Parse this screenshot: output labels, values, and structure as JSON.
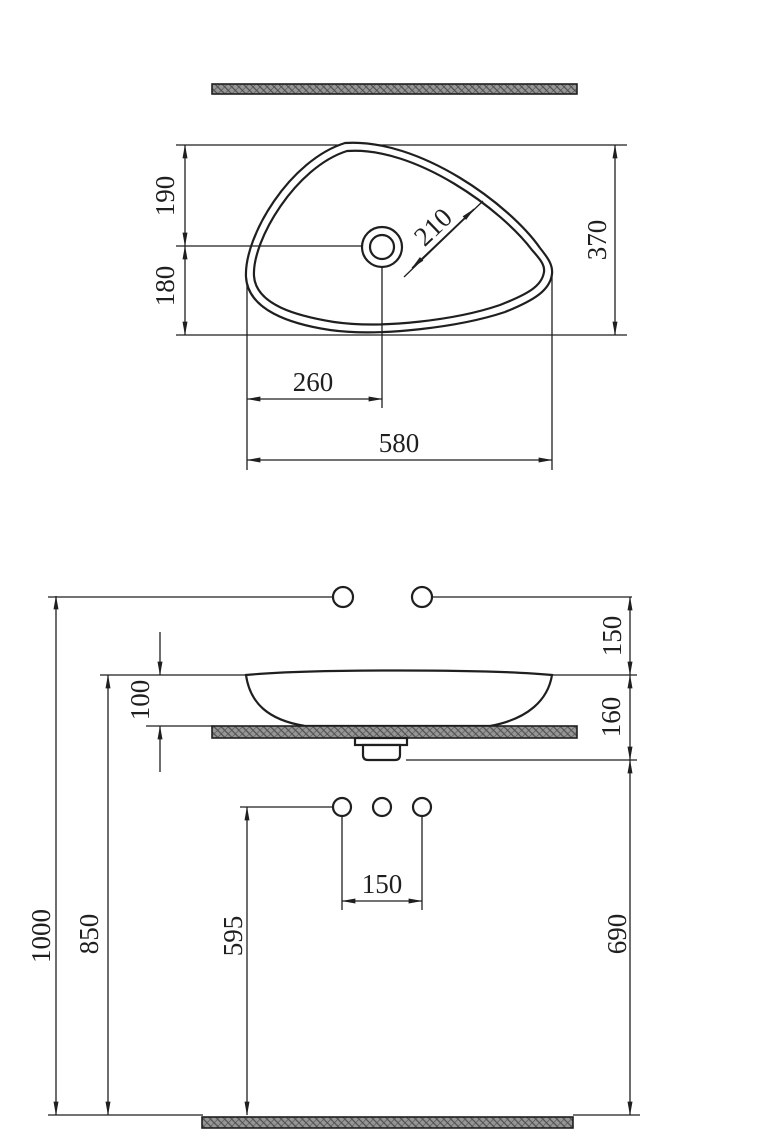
{
  "drawing": {
    "type": "vessel-washbasin installation dimension drawing",
    "views": [
      "top view",
      "front elevation"
    ]
  },
  "top_view": {
    "depth_upper": "190",
    "depth_lower": "180",
    "depth_total": "370",
    "drain_diagonal": "210",
    "drain_offset_x": "260",
    "width_total": "580"
  },
  "front_view": {
    "wall_holes_to_rim": "150",
    "basin_height": "100",
    "rim_to_drain_outlet": "160",
    "overall_height": "1000",
    "rim_height": "850",
    "deck_holes_height": "595",
    "deck_hole_spacing": "150",
    "drain_outlet_height": "690"
  },
  "colors": {
    "line": "#1f1f1f",
    "hatch": "#969696",
    "background": "#ffffff"
  }
}
